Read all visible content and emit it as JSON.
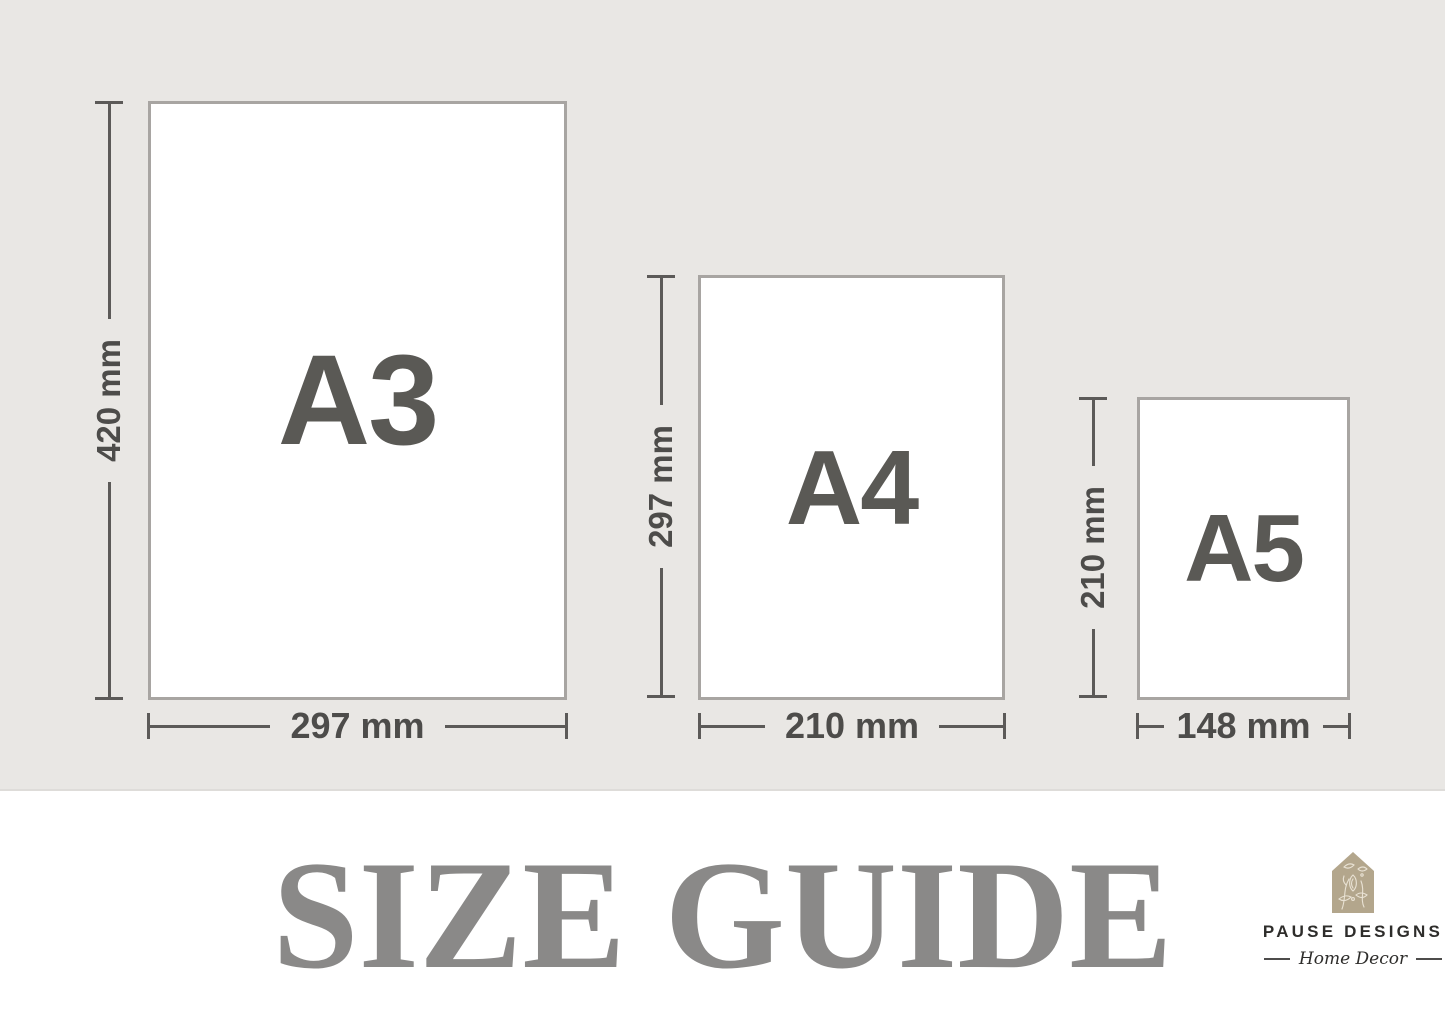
{
  "page": {
    "title": "SIZE GUIDE"
  },
  "sizes": [
    {
      "name": "A3",
      "height_label": "420 mm",
      "width_label": "297 mm"
    },
    {
      "name": "A4",
      "height_label": "297 mm",
      "width_label": "210 mm"
    },
    {
      "name": "A5",
      "height_label": "210 mm",
      "width_label": "148 mm"
    }
  ],
  "logo": {
    "brand": "PAUSE DESIGNS",
    "tagline": "Home Decor",
    "icon": "house-botanical-icon"
  },
  "colors": {
    "background": "#e9e7e4",
    "paper": "#ffffff",
    "paper_border": "#a8a5a2",
    "dim_line": "#5c5a58",
    "dim_text": "#4d4c4a",
    "size_text": "#5a5955",
    "title_text": "#8a8988",
    "brand_text": "#2e2d2b",
    "logo_beige": "#b3a68c"
  }
}
